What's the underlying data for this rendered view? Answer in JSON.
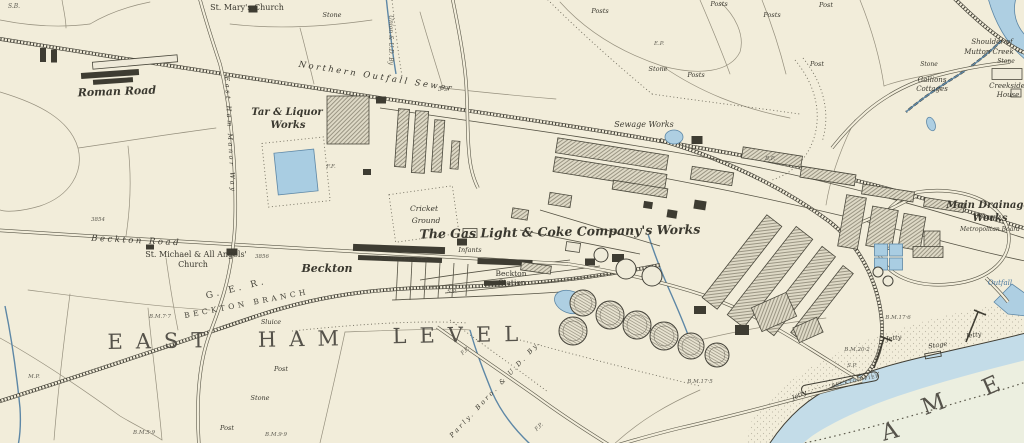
{
  "map": {
    "title": "Historic Ordnance Survey style map",
    "visible_area_names": [
      "EAST HAM LEVEL",
      "Beckton",
      "River Thames (AME letters)"
    ],
    "palette": {
      "paper": "#f2edda",
      "ink": "#3a382f",
      "water_band": "#c3dce8",
      "water_open": "#ecefe0",
      "water_fill": "#aecfe2",
      "building_dark": "#3e3c32",
      "building_hatch_bg": "#ded9c6"
    }
  },
  "labels": [
    {
      "t": "S.B.",
      "x": 14,
      "y": 8,
      "s": 6,
      "r": 0,
      "c": "tiny"
    },
    {
      "t": "St. Mary's Church",
      "x": 247,
      "y": 10,
      "s": 8,
      "r": 0,
      "c": "roman"
    },
    {
      "t": "Stone",
      "x": 332,
      "y": 17,
      "s": 6.5,
      "r": 0,
      "c": "it"
    },
    {
      "t": "Roman Road",
      "x": 117,
      "y": 95,
      "s": 11,
      "r": -2,
      "c": "bold"
    },
    {
      "t": "Tar & Liquor",
      "x": 287,
      "y": 115,
      "s": 10,
      "r": 0,
      "c": "bold"
    },
    {
      "t": "Works",
      "x": 288,
      "y": 128,
      "s": 10,
      "r": 0,
      "c": "bold"
    },
    {
      "t": "Northern Outfall Sewer",
      "x": 376,
      "y": 79,
      "s": 8.5,
      "r": 9,
      "c": "itsp"
    },
    {
      "t": "Union & U.D. By",
      "x": 389,
      "y": 40,
      "s": 6,
      "r": 90,
      "c": "tiny"
    },
    {
      "t": "5·9",
      "x": 443,
      "y": 91,
      "s": 6.5,
      "r": 0,
      "c": "tiny"
    },
    {
      "t": "Posts",
      "x": 600,
      "y": 13,
      "s": 6.5,
      "r": 0,
      "c": "it"
    },
    {
      "t": "Posts",
      "x": 719,
      "y": 6,
      "s": 6.5,
      "r": 0,
      "c": "it"
    },
    {
      "t": "Post",
      "x": 826,
      "y": 7,
      "s": 6.5,
      "r": 0,
      "c": "it"
    },
    {
      "t": "Posts",
      "x": 772,
      "y": 17,
      "s": 6.5,
      "r": 0,
      "c": "it"
    },
    {
      "t": "Post",
      "x": 817,
      "y": 66,
      "s": 6.5,
      "r": 0,
      "c": "it"
    },
    {
      "t": "Stone",
      "x": 658,
      "y": 71,
      "s": 6.5,
      "r": 0,
      "c": "it"
    },
    {
      "t": "Posts",
      "x": 696,
      "y": 77,
      "s": 6.5,
      "r": 0,
      "c": "it"
    },
    {
      "t": "E.P.",
      "x": 659,
      "y": 45,
      "s": 5.5,
      "r": 0,
      "c": "tiny"
    },
    {
      "t": "Sewage Works",
      "x": 644,
      "y": 127,
      "s": 8,
      "r": 0,
      "c": "it"
    },
    {
      "t": "Shoulder of",
      "x": 992,
      "y": 44,
      "s": 7,
      "r": 0,
      "c": "it"
    },
    {
      "t": "Mutton Creek",
      "x": 989,
      "y": 54,
      "s": 7,
      "r": 0,
      "c": "it"
    },
    {
      "t": "Stone",
      "x": 929,
      "y": 66,
      "s": 6,
      "r": 0,
      "c": "it"
    },
    {
      "t": "Stone",
      "x": 1006,
      "y": 63,
      "s": 6,
      "r": 0,
      "c": "it"
    },
    {
      "t": "Gallions",
      "x": 932,
      "y": 82,
      "s": 7,
      "r": 0,
      "c": "it"
    },
    {
      "t": "Cottages",
      "x": 932,
      "y": 91,
      "s": 7,
      "r": 0,
      "c": "it"
    },
    {
      "t": "Creekside",
      "x": 1007,
      "y": 88,
      "s": 7,
      "r": 0,
      "c": "it"
    },
    {
      "t": "House",
      "x": 1008,
      "y": 97,
      "s": 7,
      "r": 0,
      "c": "it"
    },
    {
      "t": "Main Drainage",
      "x": 988,
      "y": 208,
      "s": 10,
      "r": 0,
      "c": "bold"
    },
    {
      "t": "Works",
      "x": 990,
      "y": 221,
      "s": 10,
      "r": 0,
      "c": "bold"
    },
    {
      "t": "Metropolitan Board",
      "x": 990,
      "y": 231,
      "s": 6,
      "r": 0,
      "c": "it"
    },
    {
      "t": "Outfall",
      "x": 1000,
      "y": 285,
      "s": 7,
      "r": 0,
      "c": "blue"
    },
    {
      "t": "Cricket",
      "x": 424,
      "y": 211,
      "s": 7.5,
      "r": 0,
      "c": "it"
    },
    {
      "t": "Ground",
      "x": 426,
      "y": 223,
      "s": 7.5,
      "r": 0,
      "c": "it"
    },
    {
      "t": "The Gas Light & Coke Company's Works",
      "x": 560,
      "y": 236,
      "s": 12.5,
      "r": -1,
      "c": "bold"
    },
    {
      "t": "Beckton Road",
      "x": 136,
      "y": 243,
      "s": 8.5,
      "r": 3,
      "c": "itsp"
    },
    {
      "t": "St. Michael & All Angels'",
      "x": 196,
      "y": 257,
      "s": 8,
      "r": 0,
      "c": "roman"
    },
    {
      "t": "Church",
      "x": 193,
      "y": 267,
      "s": 8,
      "r": 0,
      "c": "roman"
    },
    {
      "t": "3854",
      "x": 98,
      "y": 221,
      "s": 5.5,
      "r": 0,
      "c": "tiny"
    },
    {
      "t": "3856",
      "x": 262,
      "y": 258,
      "s": 5.5,
      "r": 0,
      "c": "tiny"
    },
    {
      "t": "Beckton",
      "x": 327,
      "y": 272,
      "s": 11,
      "r": 0,
      "c": "bold"
    },
    {
      "t": "WINSOR TERRACE",
      "x": 400,
      "y": 260,
      "s": 4.5,
      "r": 2,
      "c": "caps"
    },
    {
      "t": "Infants",
      "x": 470,
      "y": 252,
      "s": 6.5,
      "r": 0,
      "c": "it"
    },
    {
      "t": "Beckton",
      "x": 511,
      "y": 276,
      "s": 7.5,
      "r": 0,
      "c": "roman"
    },
    {
      "t": "Station",
      "x": 512,
      "y": 285,
      "s": 7.5,
      "r": 0,
      "c": "roman"
    },
    {
      "t": "G. E. R.",
      "x": 237,
      "y": 291,
      "s": 9,
      "r": -14,
      "c": "capsp"
    },
    {
      "t": "BECKTON BRANCH",
      "x": 247,
      "y": 306,
      "s": 7.5,
      "r": -11,
      "c": "capsp"
    },
    {
      "t": "EAST",
      "x": 163,
      "y": 348,
      "s": 21,
      "r": -1,
      "c": "big"
    },
    {
      "t": "HAM",
      "x": 305,
      "y": 346,
      "s": 21,
      "r": -1,
      "c": "big"
    },
    {
      "t": "LEVEL",
      "x": 462,
      "y": 342,
      "s": 21,
      "r": -1,
      "c": "big"
    },
    {
      "t": "East Ham Manor Way",
      "x": 228,
      "y": 135,
      "s": 6.5,
      "r": 87,
      "c": "itsp"
    },
    {
      "t": "M.P.",
      "x": 34,
      "y": 378,
      "s": 5.5,
      "r": 0,
      "c": "tiny"
    },
    {
      "t": "B.M.7·7",
      "x": 160,
      "y": 318,
      "s": 5.5,
      "r": 0,
      "c": "tiny"
    },
    {
      "t": "Sluice",
      "x": 271,
      "y": 324,
      "s": 6.5,
      "r": 0,
      "c": "it"
    },
    {
      "t": "Post",
      "x": 281,
      "y": 371,
      "s": 6.5,
      "r": 0,
      "c": "it"
    },
    {
      "t": "Stone",
      "x": 260,
      "y": 400,
      "s": 6.5,
      "r": 0,
      "c": "it"
    },
    {
      "t": "Post",
      "x": 227,
      "y": 430,
      "s": 6.5,
      "r": 0,
      "c": "it"
    },
    {
      "t": "B.M.5·9",
      "x": 144,
      "y": 434,
      "s": 5.5,
      "r": 0,
      "c": "tiny"
    },
    {
      "t": "B.M.9·9",
      "x": 276,
      "y": 436,
      "s": 5.5,
      "r": 0,
      "c": "tiny"
    },
    {
      "t": "Parly. Boro. & U.D. By.",
      "x": 497,
      "y": 390,
      "s": 6.5,
      "r": -47,
      "c": "itsp"
    },
    {
      "t": "F.P.",
      "x": 466,
      "y": 352,
      "s": 5.5,
      "r": -45,
      "c": "tiny"
    },
    {
      "t": "F.P.",
      "x": 540,
      "y": 428,
      "s": 5.5,
      "r": -45,
      "c": "tiny"
    },
    {
      "t": "B.M.17·6",
      "x": 898,
      "y": 319,
      "s": 5.5,
      "r": 0,
      "c": "tiny"
    },
    {
      "t": "B.M.20·2",
      "x": 857,
      "y": 351,
      "s": 5.5,
      "r": 0,
      "c": "tiny"
    },
    {
      "t": "B.M.17·5",
      "x": 700,
      "y": 383,
      "s": 5.5,
      "r": 0,
      "c": "tiny"
    },
    {
      "t": "Jetty",
      "x": 894,
      "y": 340,
      "s": 6.5,
      "r": -8,
      "c": "it"
    },
    {
      "t": "Stage",
      "x": 938,
      "y": 347,
      "s": 6.5,
      "r": -8,
      "c": "it"
    },
    {
      "t": "Jetty",
      "x": 974,
      "y": 337,
      "s": 6.5,
      "r": -8,
      "c": "it"
    },
    {
      "t": "Jetty",
      "x": 800,
      "y": 397,
      "s": 6.5,
      "r": -24,
      "c": "it"
    },
    {
      "t": "BECKTON PIER",
      "x": 856,
      "y": 382,
      "s": 4.5,
      "r": -12,
      "c": "caps"
    },
    {
      "t": "A",
      "x": 898,
      "y": 437,
      "s": 23,
      "r": -15,
      "c": "big"
    },
    {
      "t": "M",
      "x": 942,
      "y": 409,
      "s": 23,
      "r": -20,
      "c": "big"
    },
    {
      "t": "E",
      "x": 1000,
      "y": 390,
      "s": 23,
      "r": -24,
      "c": "big"
    },
    {
      "t": "S.P.",
      "x": 452,
      "y": 293,
      "s": 5.5,
      "r": 0,
      "c": "tiny"
    },
    {
      "t": "S.P.",
      "x": 852,
      "y": 367,
      "s": 5.5,
      "r": 0,
      "c": "tiny"
    },
    {
      "t": "B.P.",
      "x": 770,
      "y": 160,
      "s": 5.5,
      "r": 0,
      "c": "tiny"
    },
    {
      "t": "F.F.",
      "x": 331,
      "y": 168,
      "s": 5.5,
      "r": 0,
      "c": "tiny"
    }
  ],
  "buildings": [
    {
      "x": 110,
      "y": 74,
      "w": 58,
      "h": 6,
      "r": -4,
      "f": "d"
    },
    {
      "x": 113,
      "y": 81,
      "w": 40,
      "h": 5,
      "r": -4,
      "f": "d"
    },
    {
      "x": 135,
      "y": 62,
      "w": 85,
      "h": 7,
      "r": -5,
      "f": "o"
    },
    {
      "x": 43,
      "y": 55,
      "w": 6,
      "h": 14,
      "r": 0,
      "f": "d"
    },
    {
      "x": 54,
      "y": 56,
      "w": 6,
      "h": 13,
      "r": 0,
      "f": "d"
    },
    {
      "x": 253,
      "y": 9,
      "w": 9,
      "h": 7,
      "r": 0,
      "f": "d"
    },
    {
      "x": 232,
      "y": 252,
      "w": 11,
      "h": 7,
      "r": 0,
      "f": "d"
    },
    {
      "x": 150,
      "y": 247,
      "w": 8,
      "h": 5,
      "r": 0,
      "f": "d"
    },
    {
      "x": 348,
      "y": 120,
      "w": 42,
      "h": 48,
      "r": 0,
      "f": "h"
    },
    {
      "x": 402,
      "y": 138,
      "w": 11,
      "h": 58,
      "r": 4,
      "f": "h"
    },
    {
      "x": 420,
      "y": 142,
      "w": 13,
      "h": 62,
      "r": 4,
      "f": "h"
    },
    {
      "x": 438,
      "y": 146,
      "w": 10,
      "h": 52,
      "r": 4,
      "f": "h"
    },
    {
      "x": 455,
      "y": 155,
      "w": 8,
      "h": 28,
      "r": 4,
      "f": "h"
    },
    {
      "x": 381,
      "y": 100,
      "w": 10,
      "h": 7,
      "r": 0,
      "f": "d"
    },
    {
      "x": 367,
      "y": 172,
      "w": 8,
      "h": 6,
      "r": 0,
      "f": "d"
    },
    {
      "x": 296,
      "y": 172,
      "w": 40,
      "h": 42,
      "r": -6,
      "f": "b"
    },
    {
      "x": 399,
      "y": 249,
      "w": 92,
      "h": 7,
      "r": 2,
      "f": "d"
    },
    {
      "x": 400,
      "y": 259,
      "w": 84,
      "h": 5,
      "r": 2,
      "f": "d"
    },
    {
      "x": 505,
      "y": 262,
      "w": 55,
      "h": 6,
      "r": 2,
      "f": "d"
    },
    {
      "x": 462,
      "y": 242,
      "w": 10,
      "h": 7,
      "r": 0,
      "f": "d"
    },
    {
      "x": 495,
      "y": 283,
      "w": 22,
      "h": 5,
      "r": -2,
      "f": "d"
    },
    {
      "x": 536,
      "y": 268,
      "w": 30,
      "h": 8,
      "r": 8,
      "f": "h"
    },
    {
      "x": 573,
      "y": 247,
      "w": 14,
      "h": 9,
      "r": 8,
      "f": "o"
    },
    {
      "x": 612,
      "y": 154,
      "w": 112,
      "h": 15,
      "r": 9,
      "f": "h"
    },
    {
      "x": 610,
      "y": 173,
      "w": 113,
      "h": 15,
      "r": 9,
      "f": "h"
    },
    {
      "x": 640,
      "y": 189,
      "w": 55,
      "h": 9,
      "r": 9,
      "f": "h"
    },
    {
      "x": 712,
      "y": 176,
      "w": 42,
      "h": 13,
      "r": 9,
      "f": "h"
    },
    {
      "x": 772,
      "y": 157,
      "w": 60,
      "h": 11,
      "r": 9,
      "f": "h"
    },
    {
      "x": 828,
      "y": 176,
      "w": 55,
      "h": 11,
      "r": 9,
      "f": "h"
    },
    {
      "x": 888,
      "y": 193,
      "w": 52,
      "h": 10,
      "r": 9,
      "f": "h"
    },
    {
      "x": 944,
      "y": 205,
      "w": 40,
      "h": 9,
      "r": 9,
      "f": "h"
    },
    {
      "x": 742,
      "y": 262,
      "w": 19,
      "h": 105,
      "r": 38,
      "f": "h"
    },
    {
      "x": 770,
      "y": 277,
      "w": 21,
      "h": 112,
      "r": 38,
      "f": "h"
    },
    {
      "x": 798,
      "y": 291,
      "w": 17,
      "h": 100,
      "r": 38,
      "f": "h"
    },
    {
      "x": 822,
      "y": 303,
      "w": 13,
      "h": 85,
      "r": 38,
      "f": "h"
    },
    {
      "x": 852,
      "y": 222,
      "w": 20,
      "h": 52,
      "r": 10,
      "f": "h"
    },
    {
      "x": 882,
      "y": 228,
      "w": 26,
      "h": 40,
      "r": 10,
      "f": "h"
    },
    {
      "x": 912,
      "y": 232,
      "w": 22,
      "h": 34,
      "r": 10,
      "f": "h"
    },
    {
      "x": 700,
      "y": 205,
      "w": 12,
      "h": 9,
      "r": 9,
      "f": "d"
    },
    {
      "x": 672,
      "y": 214,
      "w": 10,
      "h": 8,
      "r": 9,
      "f": "d"
    },
    {
      "x": 648,
      "y": 205,
      "w": 9,
      "h": 7,
      "r": 9,
      "f": "d"
    },
    {
      "x": 560,
      "y": 200,
      "w": 22,
      "h": 12,
      "r": 9,
      "f": "h"
    },
    {
      "x": 520,
      "y": 214,
      "w": 16,
      "h": 10,
      "r": 9,
      "f": "h"
    },
    {
      "x": 470,
      "y": 233,
      "w": 14,
      "h": 9,
      "r": 0,
      "f": "o"
    },
    {
      "x": 774,
      "y": 312,
      "w": 38,
      "h": 26,
      "r": -24,
      "f": "h"
    },
    {
      "x": 808,
      "y": 330,
      "w": 26,
      "h": 16,
      "r": -24,
      "f": "h"
    },
    {
      "x": 742,
      "y": 330,
      "w": 14,
      "h": 10,
      "r": 0,
      "f": "d"
    },
    {
      "x": 700,
      "y": 310,
      "w": 12,
      "h": 8,
      "r": 0,
      "f": "d"
    },
    {
      "x": 618,
      "y": 258,
      "w": 12,
      "h": 8,
      "r": 0,
      "f": "d"
    },
    {
      "x": 590,
      "y": 262,
      "w": 10,
      "h": 7,
      "r": 0,
      "f": "d"
    },
    {
      "x": 932,
      "y": 244,
      "w": 16,
      "h": 26,
      "r": 0,
      "f": "h"
    },
    {
      "x": 928,
      "y": 252,
      "w": 30,
      "h": 11,
      "r": 0,
      "f": "h"
    },
    {
      "x": 881,
      "y": 250,
      "w": 13,
      "h": 12,
      "r": 0,
      "f": "b"
    },
    {
      "x": 896,
      "y": 250,
      "w": 13,
      "h": 12,
      "r": 0,
      "f": "b"
    },
    {
      "x": 881,
      "y": 264,
      "w": 13,
      "h": 12,
      "r": 0,
      "f": "b"
    },
    {
      "x": 896,
      "y": 264,
      "w": 13,
      "h": 12,
      "r": 0,
      "f": "b"
    },
    {
      "x": 1007,
      "y": 74,
      "w": 30,
      "h": 11,
      "r": 0,
      "f": "o"
    },
    {
      "x": 1016,
      "y": 93,
      "w": 10,
      "h": 8,
      "r": 0,
      "f": "o"
    },
    {
      "x": 697,
      "y": 140,
      "w": 11,
      "h": 8,
      "r": 0,
      "f": "d"
    }
  ],
  "gas_holders": [
    {
      "cx": 601,
      "cy": 255,
      "r": 7,
      "h": 0
    },
    {
      "cx": 626,
      "cy": 269,
      "r": 10,
      "h": 0
    },
    {
      "cx": 652,
      "cy": 276,
      "r": 10,
      "h": 0
    },
    {
      "cx": 583,
      "cy": 303,
      "r": 13,
      "h": 1
    },
    {
      "cx": 573,
      "cy": 331,
      "r": 14,
      "h": 1
    },
    {
      "cx": 610,
      "cy": 315,
      "r": 14,
      "h": 1
    },
    {
      "cx": 637,
      "cy": 325,
      "r": 14,
      "h": 1
    },
    {
      "cx": 664,
      "cy": 336,
      "r": 14,
      "h": 1
    },
    {
      "cx": 691,
      "cy": 346,
      "r": 13,
      "h": 1
    },
    {
      "cx": 717,
      "cy": 355,
      "r": 12,
      "h": 1
    },
    {
      "cx": 878,
      "cy": 272,
      "r": 5,
      "h": 0
    },
    {
      "cx": 888,
      "cy": 281,
      "r": 5,
      "h": 0
    }
  ],
  "ponds": [
    {
      "cx": 674,
      "cy": 137,
      "rx": 9,
      "ry": 7,
      "r": 0
    },
    {
      "cx": 570,
      "cy": 302,
      "rx": 16,
      "ry": 11,
      "r": 20
    },
    {
      "cx": 344,
      "cy": 137,
      "rx": 6,
      "ry": 4,
      "r": 0
    },
    {
      "cx": 359,
      "cy": 133,
      "rx": 6,
      "ry": 4,
      "r": 0
    },
    {
      "cx": 931,
      "cy": 124,
      "rx": 4,
      "ry": 7,
      "r": -20
    }
  ]
}
